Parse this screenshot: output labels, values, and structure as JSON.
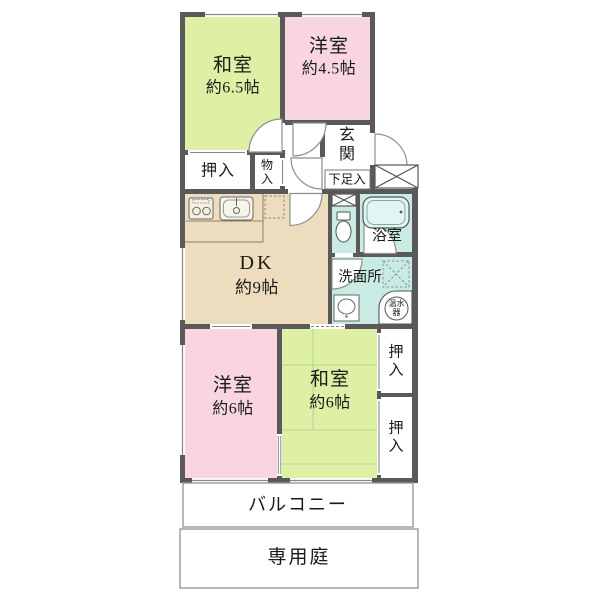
{
  "plan": {
    "title": "apartment-floor-plan",
    "rooms": {
      "washitsu_65": {
        "name": "和室",
        "size": "約6.5帖"
      },
      "yoshitsu_45": {
        "name": "洋室",
        "size": "約4.5帖"
      },
      "oshiire_top": {
        "name": "押入"
      },
      "mono_ire": {
        "name": "物\n入"
      },
      "genkan": {
        "name": "玄\n関"
      },
      "getabako": {
        "name": "下足入"
      },
      "dk": {
        "name": "DK",
        "size": "約9帖"
      },
      "bathroom": {
        "name": "浴室"
      },
      "washroom": {
        "name": "洗面所"
      },
      "water_heater": {
        "name": "温水\n器"
      },
      "yoshitsu_6": {
        "name": "洋室",
        "size": "約6帖"
      },
      "washitsu_6": {
        "name": "和室",
        "size": "約6帖"
      },
      "oshiire_r1": {
        "name": "押\n入"
      },
      "oshiire_r2": {
        "name": "押\n入"
      },
      "balcony": {
        "name": "バルコニー"
      },
      "garden": {
        "name": "専用庭"
      }
    },
    "colors": {
      "wall": "#595959",
      "tatami_green": "#ddf0a5",
      "western_pink": "#f8d5df",
      "dk_beige": "#eddcbd",
      "wet_teal": "#c9ebe3",
      "tub_fill": "#e2f5f3",
      "line_gray": "#888888",
      "text": "#1a1a1a"
    }
  }
}
